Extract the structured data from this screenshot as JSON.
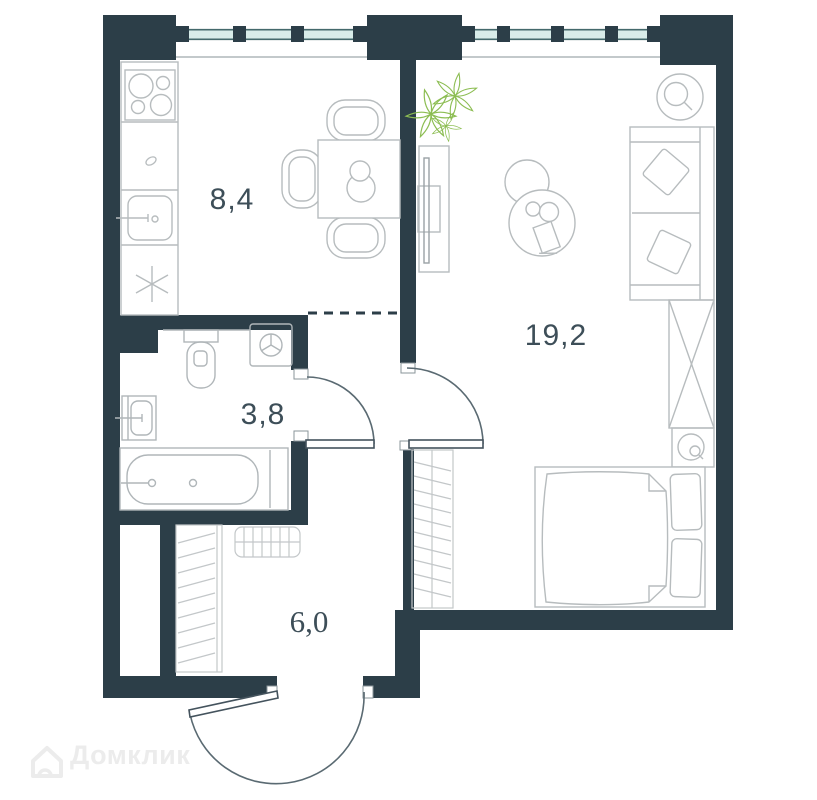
{
  "plan": {
    "type": "apartment-floor-plan",
    "rooms": {
      "kitchen": {
        "name": "kitchen-dining",
        "area": "8,4"
      },
      "living": {
        "name": "living-bedroom",
        "area": "19,2"
      },
      "bathroom": {
        "name": "bathroom",
        "area": "3,8"
      },
      "hallway": {
        "name": "hallway",
        "area": "6,0"
      }
    },
    "fixtures": [
      "stove-icon",
      "kitchen-sink-icon",
      "fridge-snowflake-icon",
      "dining-table-icon",
      "chair-icon",
      "decanter-icon",
      "plant-icon",
      "tv-console-icon",
      "coffee-tables-icon",
      "floor-lamp-icon",
      "sofa-icon",
      "pillow-icon",
      "wardrobe-x-icon",
      "nightstand-lamp-icon",
      "double-bed-icon",
      "toilet-icon",
      "washing-machine-icon",
      "wash-basin-icon",
      "bathtub-icon",
      "hall-closet-icon",
      "living-closet-icon",
      "shoe-rack-icon",
      "door-arc-icon",
      "window-band-icon"
    ],
    "colors": {
      "wall": "#2c3e48",
      "window_glass": "#d8ece9",
      "window_frame": "#44696c",
      "furniture": "#b7bcbe",
      "furniture_dark": "#9aa1a5",
      "door": "#44535d",
      "door_arc": "#5a6a72",
      "label": "#3d4e58",
      "plant": "#8cbd52",
      "watermark": "#ececec"
    }
  },
  "watermark": {
    "text": "Домклик",
    "logo": "domclick-house-logo"
  }
}
